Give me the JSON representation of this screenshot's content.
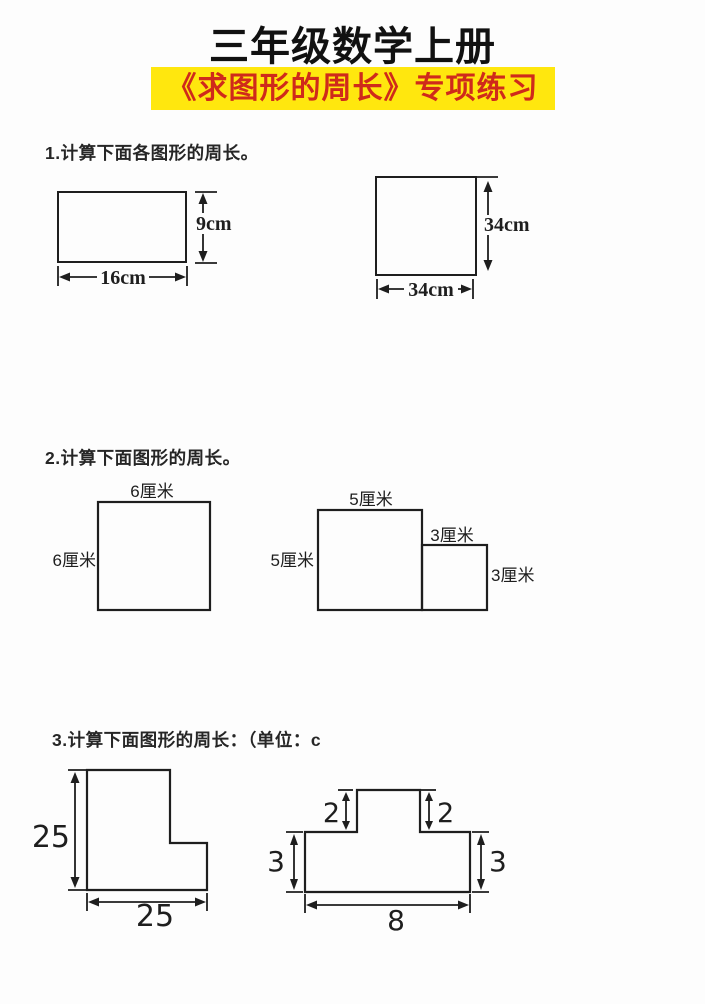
{
  "page": {
    "title": "三年级数学上册",
    "subtitle": "《求图形的周长》专项练习",
    "colors": {
      "highlight_yellow": "#ffe70e",
      "subtitle_red": "#cf2a1b",
      "ink": "#1e1e1e",
      "paper": "#fdfdfd"
    }
  },
  "sections": [
    {
      "heading": "1.计算下面各图形的周长。"
    },
    {
      "heading": "2.计算下面图形的周长。"
    },
    {
      "heading": "3.计算下面图形的周长：（单位：c"
    }
  ],
  "figures": {
    "rect16x9": {
      "height_label": "9cm",
      "width_label": "16cm"
    },
    "square34": {
      "height_label": "34cm",
      "width_label": "34cm"
    },
    "square6": {
      "top_label": "6厘米",
      "left_label": "6厘米"
    },
    "composite53": {
      "top_label": "5厘米",
      "left_label": "5厘米",
      "step_top_label": "3厘米",
      "right_label": "3厘米"
    },
    "lshape25": {
      "height_label": "25",
      "width_label": "25"
    },
    "tshape": {
      "left_top_label": "2",
      "right_top_label": "2",
      "left_side_label": "3",
      "right_side_label": "3",
      "bottom_label": "8"
    }
  }
}
